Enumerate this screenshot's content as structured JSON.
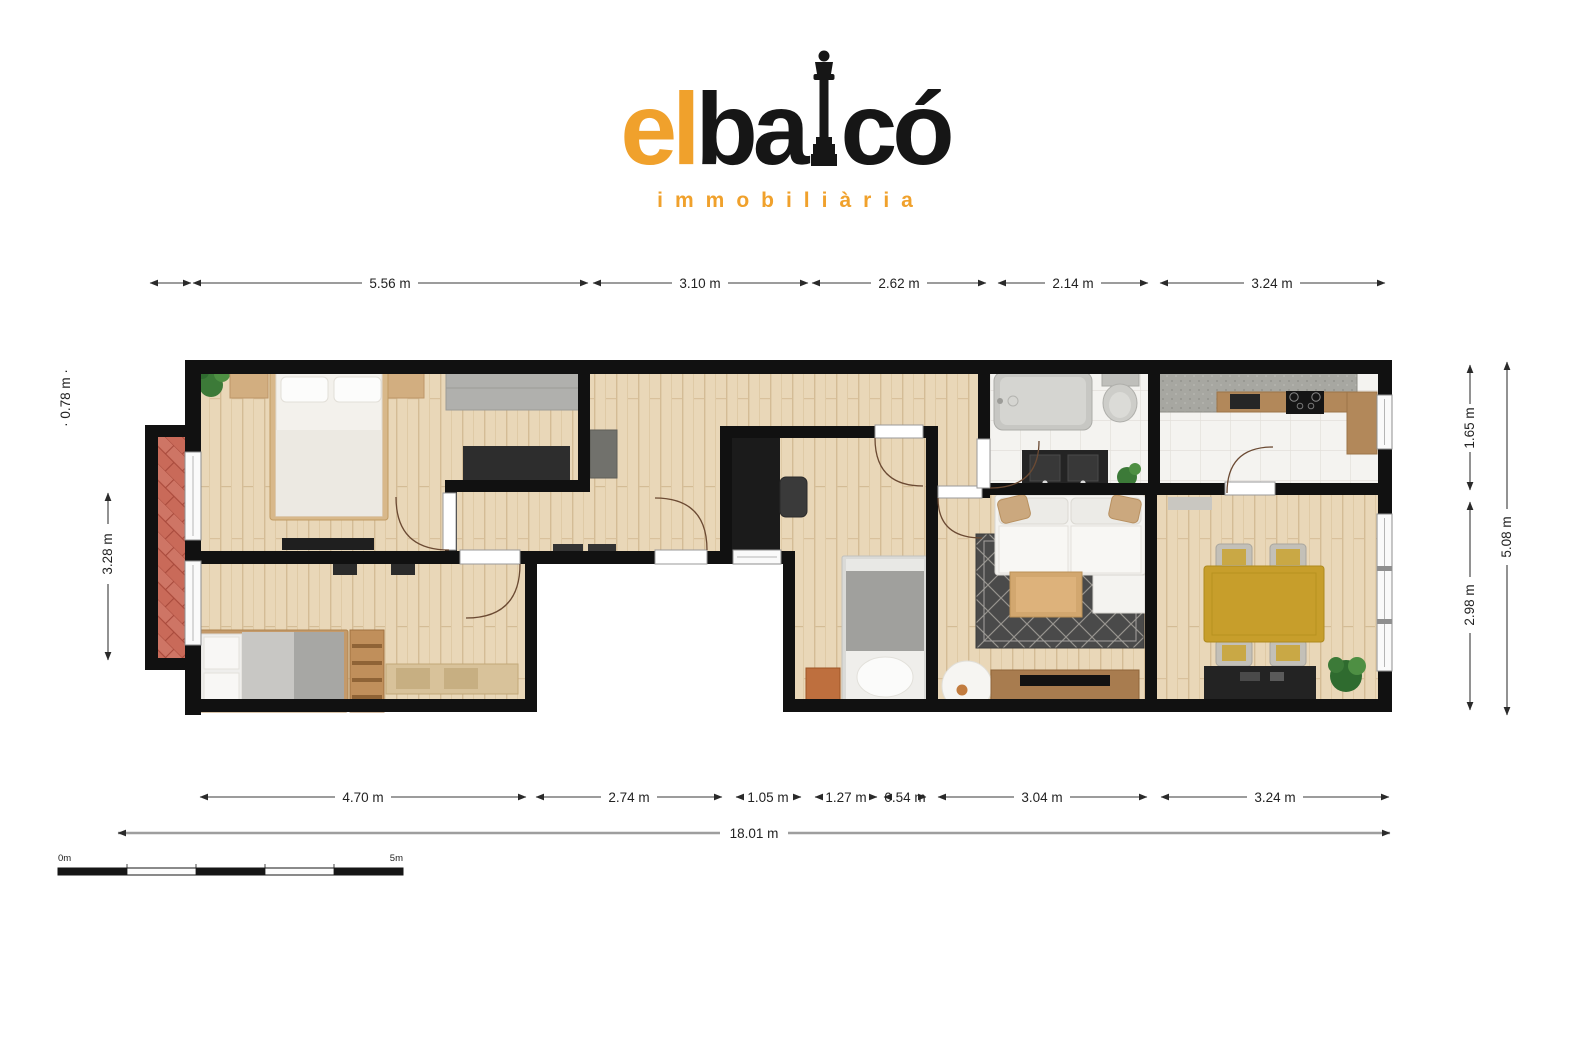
{
  "logo": {
    "part_el": "el",
    "part_ba": "ba",
    "part_co": "có",
    "subtitle": "immobiliària"
  },
  "colors": {
    "brand_orange": "#F0A12C",
    "ink": "#161616",
    "wall_black": "#111111",
    "wood_floor": "#E9D7B8",
    "tile_floor": "#F4F3F0",
    "balcony_brick": "#C96A59",
    "dining_table_yellow": "#C79E2B",
    "terracotta_nightstand": "#BE6F3E"
  },
  "dims": {
    "top": [
      "",
      "5.56 m",
      "3.10 m",
      "2.62 m",
      "2.14 m",
      "3.24 m"
    ],
    "bottom": [
      "4.70 m",
      "2.74 m",
      "1.05 m",
      "1.27 m",
      "0.54 m",
      "3.04 m",
      "3.24 m"
    ],
    "total_width": "18.01 m",
    "left_small": "· 0.78 m ·",
    "left_main": "3.28 m",
    "right_top": "1.65 m",
    "right_bottom": "2.98 m",
    "right_total": "5.08 m"
  },
  "scale_bar": {
    "start": "0m",
    "end": "5m"
  }
}
